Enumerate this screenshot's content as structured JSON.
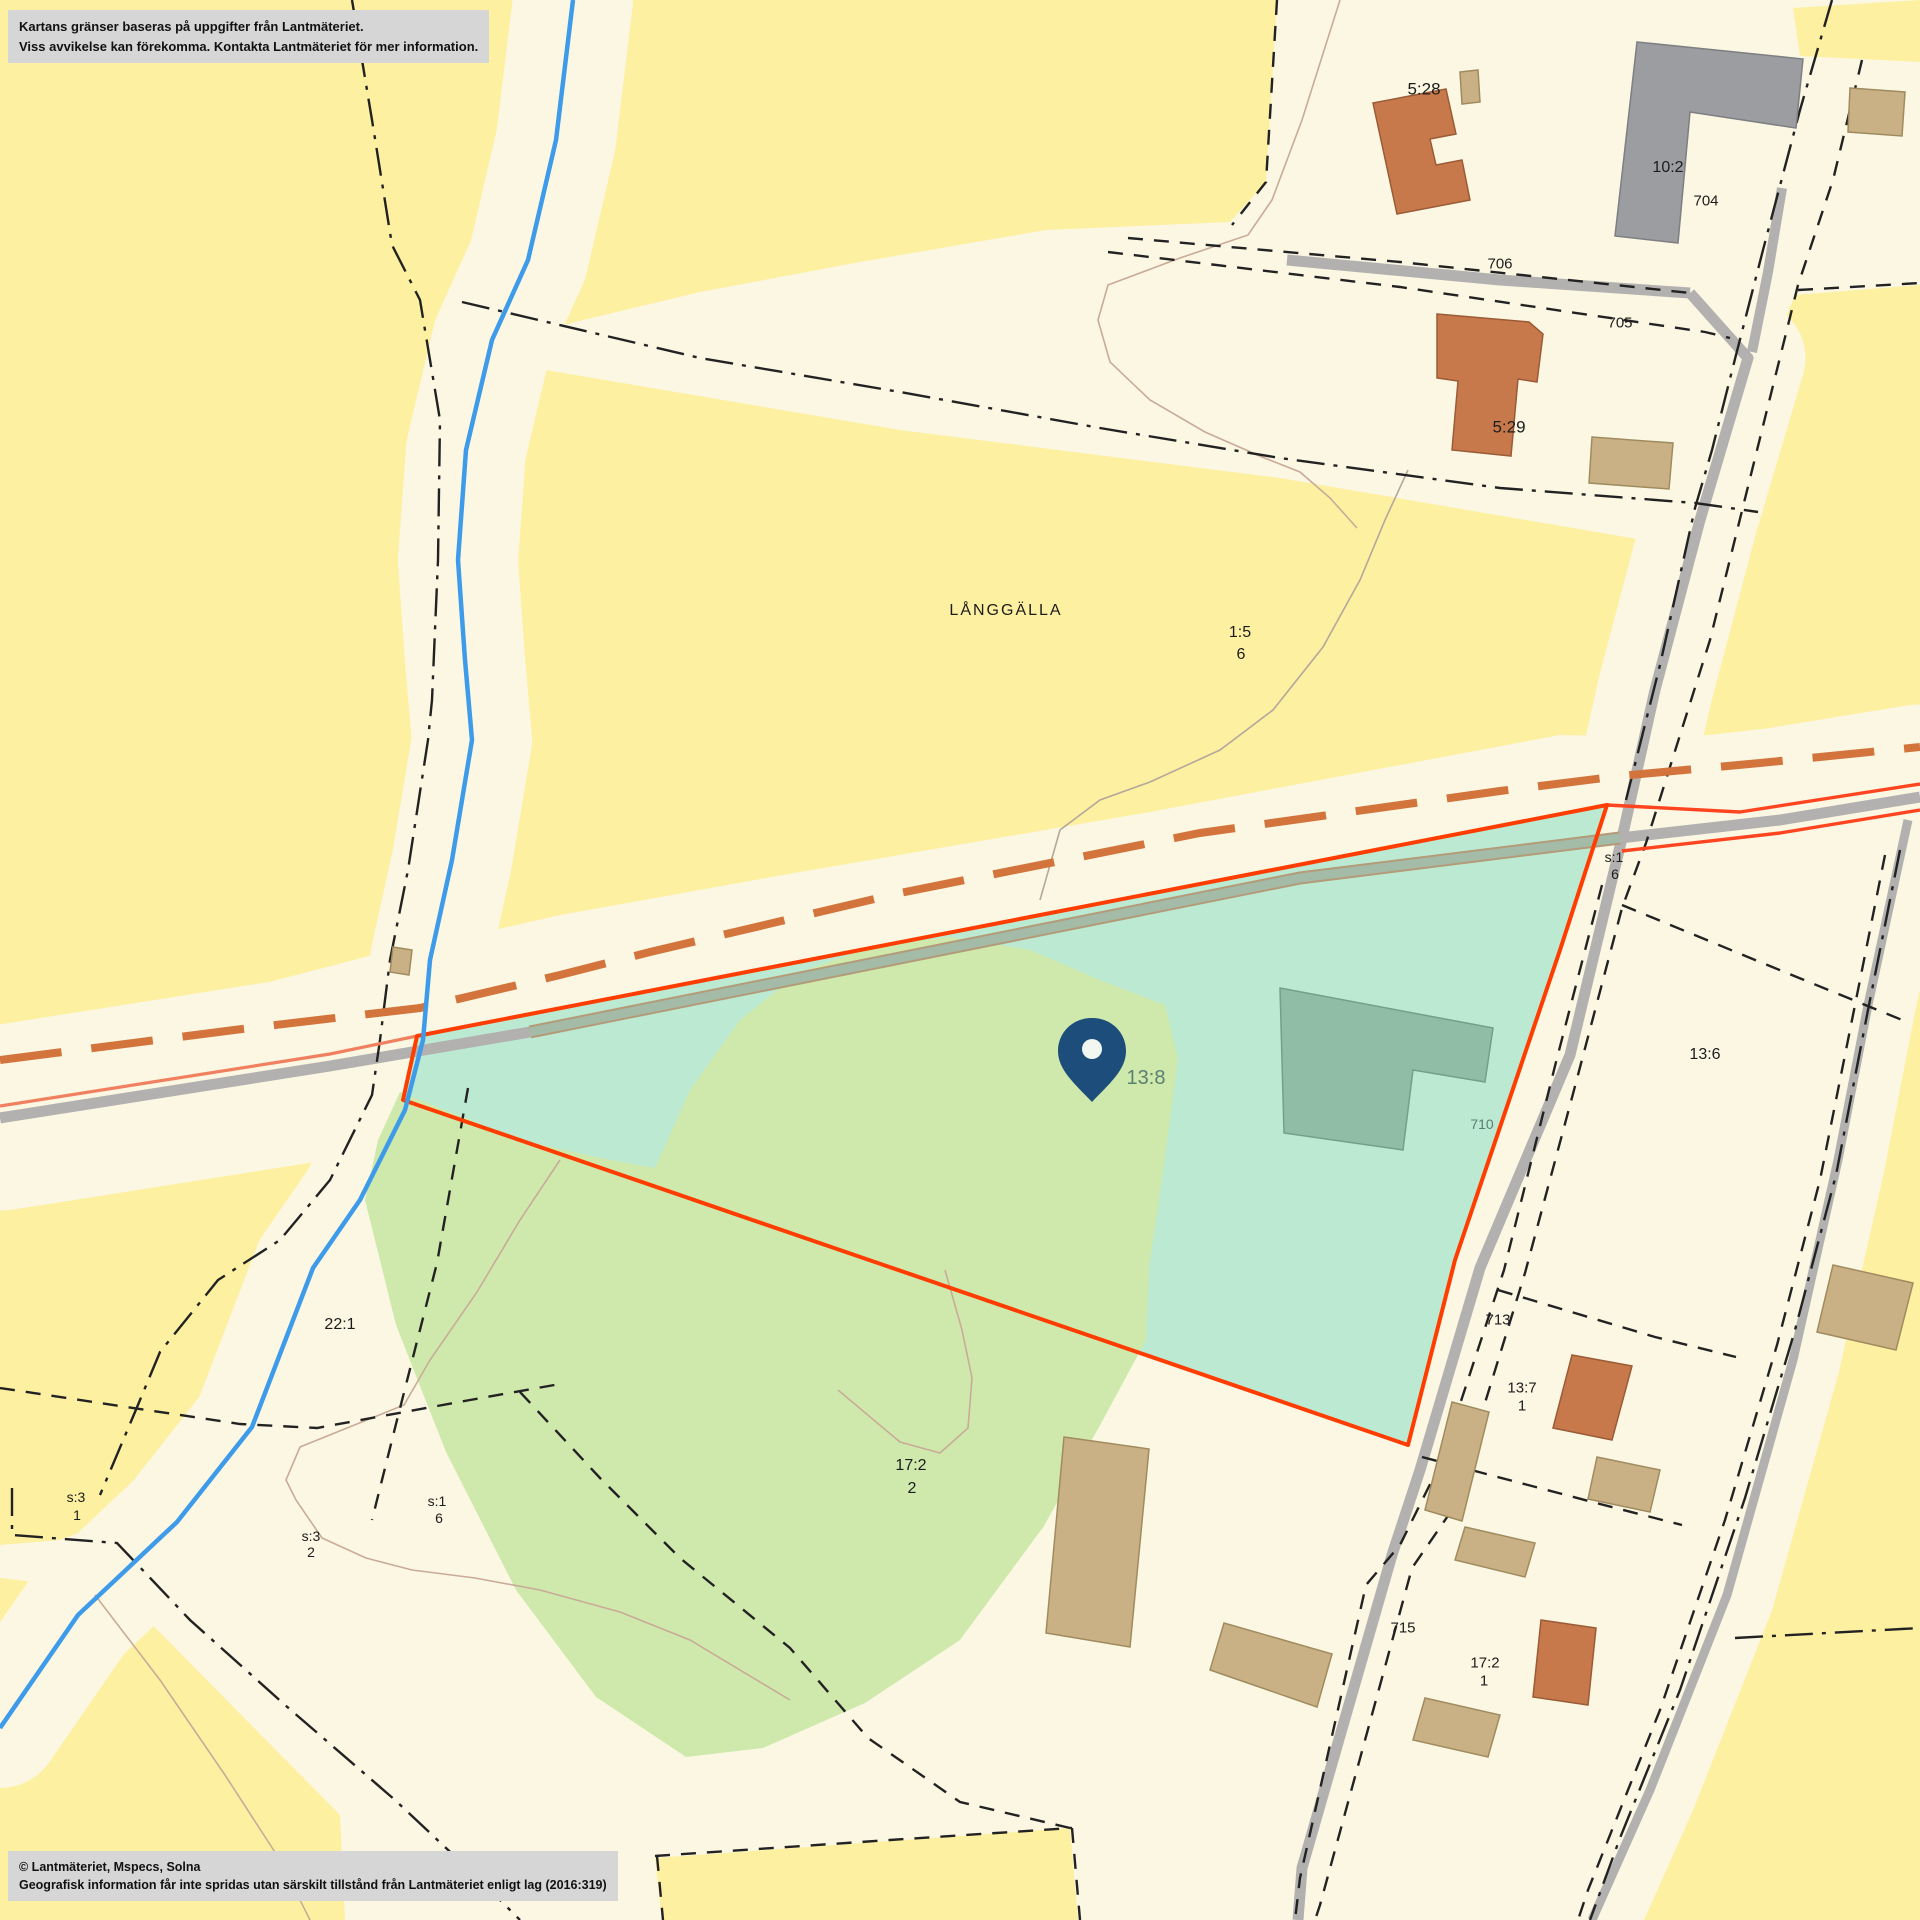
{
  "map": {
    "disclaimer": {
      "line1": "Kartans gränser baseras på uppgifter från Lantmäteriet.",
      "line2": "Viss avvikelse kan förekomma. Kontakta Lantmäteriet för mer information."
    },
    "copyright": {
      "line1": "© Lantmäteriet, Mspecs, Solna",
      "line2": "Geografisk information får inte spridas utan särskilt tillstånd från Lantmäteriet enligt lag (2016:319)"
    },
    "selected_parcel": "13:8",
    "place_name": "LÅNGGÄLLA",
    "colors": {
      "field_yellow": "#fdf0a1",
      "base_cream": "#fbf7e3",
      "parcel_highlight": "#bce9d1",
      "vegetation_green": "#cfe9ad",
      "parcel_boundary_red": "#ff3d00",
      "road_gray": "#b2b1b0",
      "water_blue": "#3d9be9",
      "pin_navy": "#1d4d7a",
      "building_brown": "#c8794b",
      "building_tan": "#c9b185",
      "building_gray": "#9b9da1",
      "orange_dash_path": "#d2743c"
    },
    "labels": [
      {
        "text": "5:28",
        "x": 1424,
        "y": 89,
        "size": 17
      },
      {
        "text": "10:2",
        "x": 1668,
        "y": 168,
        "size": 16
      },
      {
        "text": "704",
        "x": 1706,
        "y": 201,
        "size": 15
      },
      {
        "text": "706",
        "x": 1500,
        "y": 264,
        "size": 15
      },
      {
        "text": "705",
        "x": 1620,
        "y": 323,
        "size": 15
      },
      {
        "text": "5:29",
        "x": 1509,
        "y": 427,
        "size": 17
      },
      {
        "text": "LÅNGGÄLLA",
        "x": 1006,
        "y": 611,
        "size": 16,
        "ls": 2
      },
      {
        "text": "1:5",
        "x": 1240,
        "y": 633,
        "size": 16
      },
      {
        "text": "6",
        "x": 1241,
        "y": 655,
        "size": 16
      },
      {
        "text": "s:1",
        "x": 1614,
        "y": 857,
        "size": 14
      },
      {
        "text": "6",
        "x": 1615,
        "y": 874,
        "size": 14
      },
      {
        "text": "13:8",
        "x": 1146,
        "y": 1078,
        "size": 20,
        "color": "#5a8070"
      },
      {
        "text": "13:6",
        "x": 1705,
        "y": 1055,
        "size": 16
      },
      {
        "text": "710",
        "x": 1482,
        "y": 1124,
        "size": 14,
        "color": "#5a8070"
      },
      {
        "text": "22:1",
        "x": 340,
        "y": 1325,
        "size": 16
      },
      {
        "text": "713",
        "x": 1498,
        "y": 1320,
        "size": 15
      },
      {
        "text": "13:7",
        "x": 1522,
        "y": 1388,
        "size": 15
      },
      {
        "text": "1",
        "x": 1522,
        "y": 1406,
        "size": 15
      },
      {
        "text": "17:2",
        "x": 911,
        "y": 1466,
        "size": 16
      },
      {
        "text": "2",
        "x": 912,
        "y": 1489,
        "size": 16
      },
      {
        "text": "s:3",
        "x": 76,
        "y": 1497,
        "size": 14
      },
      {
        "text": "1",
        "x": 77,
        "y": 1515,
        "size": 14
      },
      {
        "text": "s:1",
        "x": 437,
        "y": 1501,
        "size": 14
      },
      {
        "text": "6",
        "x": 439,
        "y": 1518,
        "size": 14
      },
      {
        "text": "s:3",
        "x": 311,
        "y": 1536,
        "size": 14
      },
      {
        "text": "2",
        "x": 311,
        "y": 1552,
        "size": 14
      },
      {
        "text": "715",
        "x": 1403,
        "y": 1628,
        "size": 15
      },
      {
        "text": "17:2",
        "x": 1485,
        "y": 1663,
        "size": 15
      },
      {
        "text": "1",
        "x": 1484,
        "y": 1681,
        "size": 15
      }
    ]
  }
}
